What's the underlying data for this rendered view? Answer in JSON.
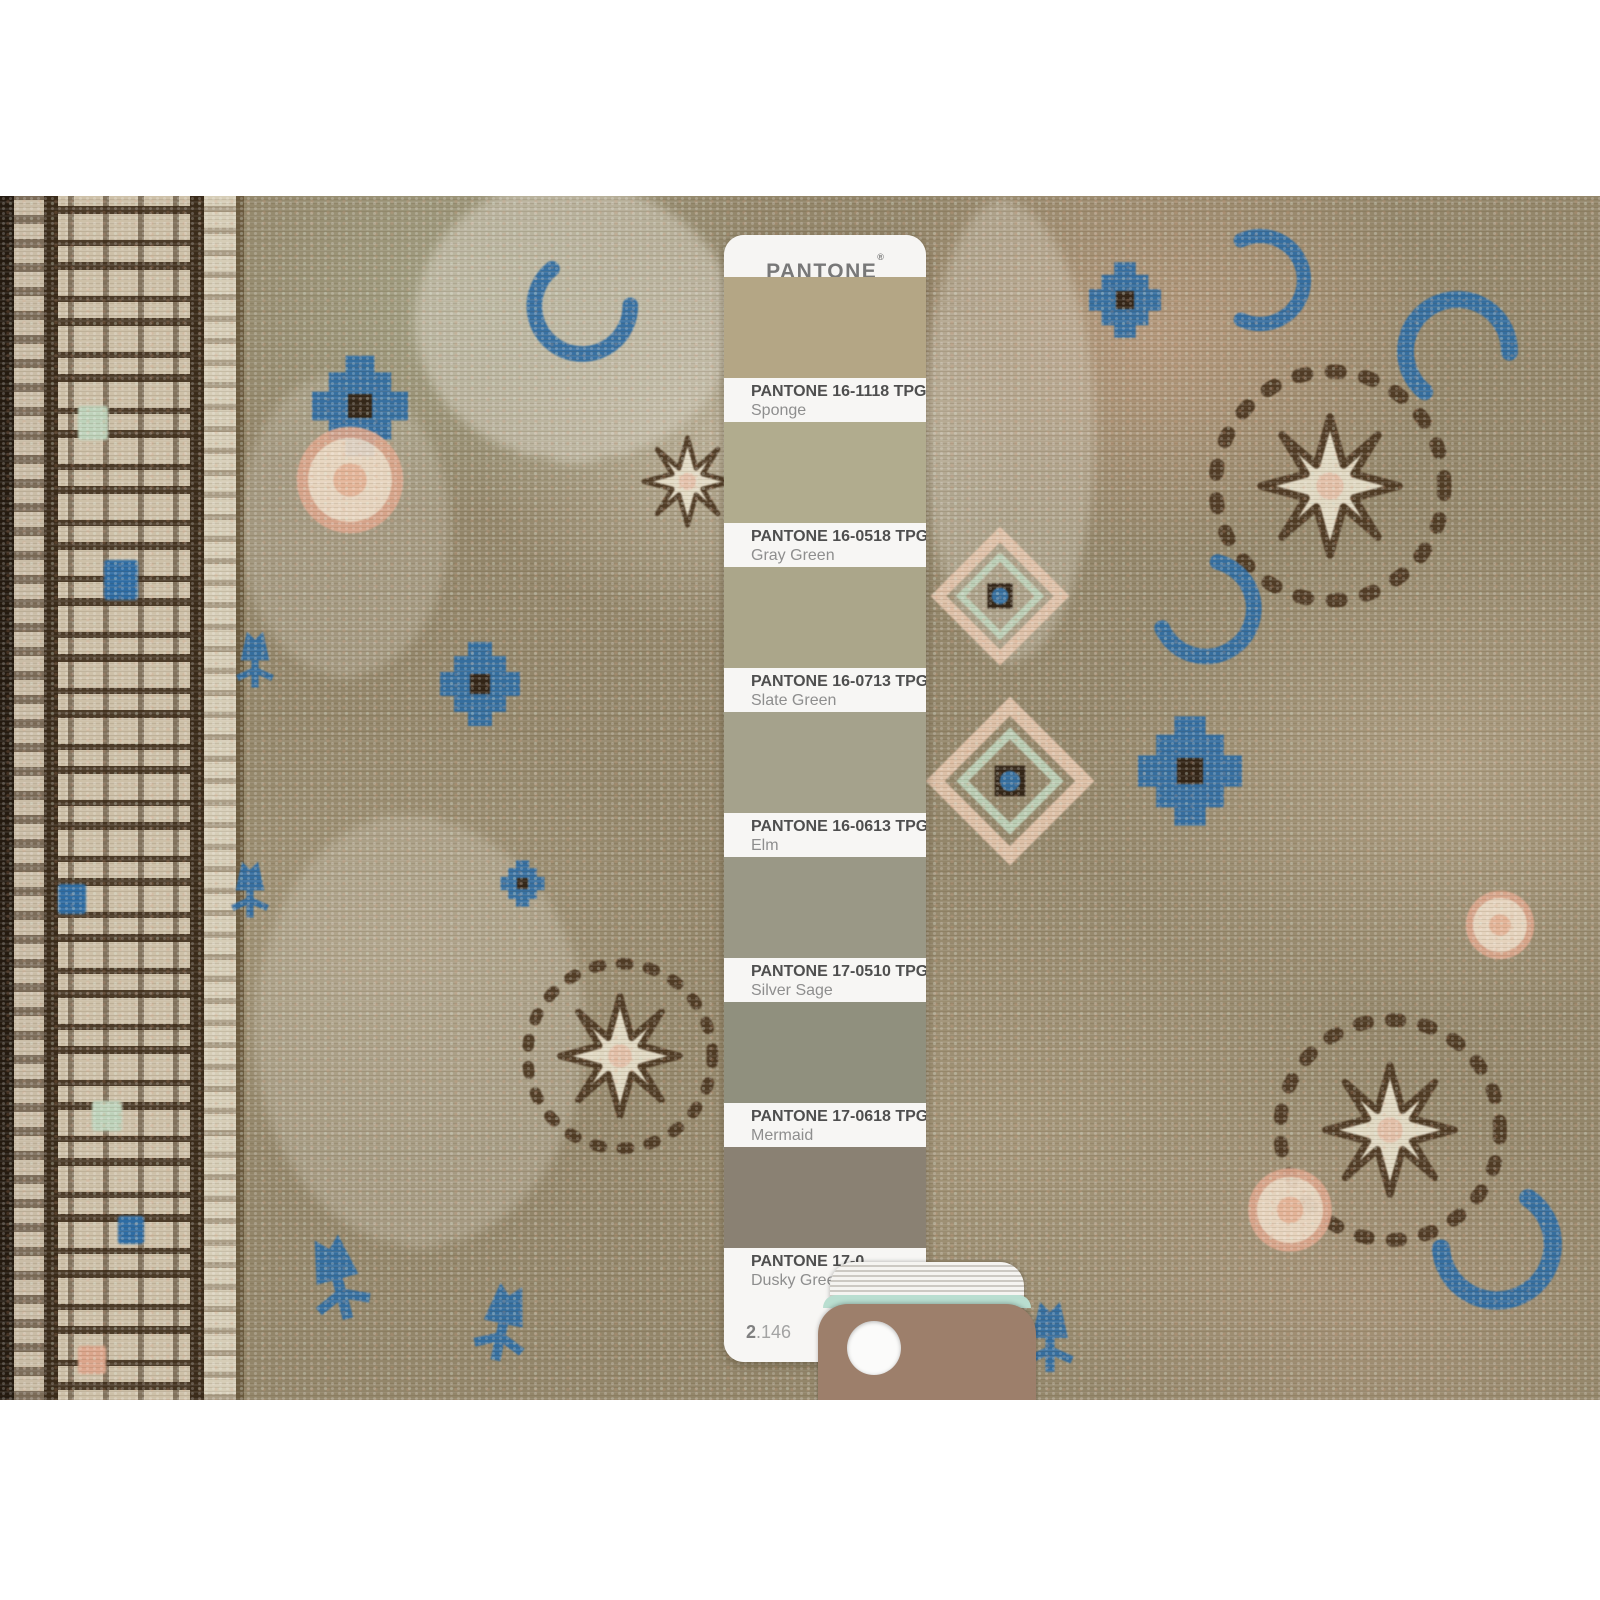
{
  "photo": {
    "subject": "vintage handmade rug with Pantone color guide",
    "rug_palette": {
      "field_olive": "#93866a",
      "ivory": "#e7dfca",
      "dark_brown": "#4b3620",
      "border_brown": "#3a2b1a",
      "blue": "#2e6ca3",
      "salmon": "#dba58b",
      "mint": "#bdd2ba",
      "border_ground": "#cdc0a8"
    }
  },
  "pantone_card": {
    "brand": "PANTONE",
    "registered_mark": "®",
    "swatches": [
      {
        "code": "PANTONE 16-1118 TPG",
        "name": "Sponge",
        "color": "#b4a685"
      },
      {
        "code": "PANTONE 16-0518 TPG",
        "name": "Gray Green",
        "color": "#b1ac8e"
      },
      {
        "code": "PANTONE 16-0713 TPG",
        "name": "Slate Green",
        "color": "#aba68a"
      },
      {
        "code": "PANTONE 16-0613 TPG",
        "name": "Elm",
        "color": "#a5a28c"
      },
      {
        "code": "PANTONE 17-0510 TPG",
        "name": "Silver Sage",
        "color": "#9a9886"
      },
      {
        "code": "PANTONE 17-0618 TPG",
        "name": "Mermaid",
        "color": "#90907e"
      },
      {
        "code": "PANTONE 17-0",
        "name": "Dusky Green",
        "color": "#8a8173"
      }
    ],
    "page_number_bold": "2",
    "page_number_rest": ".146"
  },
  "fan_deck": {
    "top_card_color": "#9d7f6b",
    "edge_accent_color": "#b9ded0"
  }
}
